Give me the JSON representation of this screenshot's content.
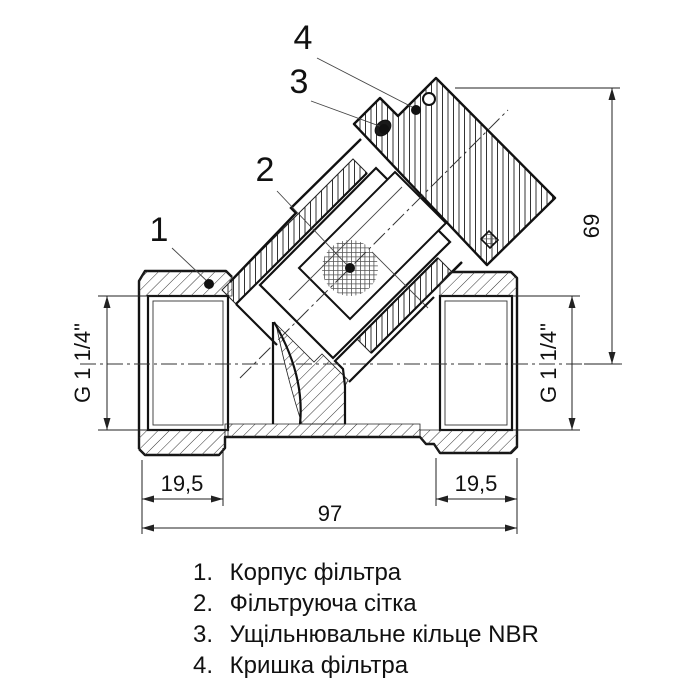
{
  "drawing": {
    "callouts": {
      "c1": "1",
      "c2": "2",
      "c3": "3",
      "c4": "4"
    },
    "dimensions": {
      "thread_left": "G 1 1/4\"",
      "thread_right": "G 1 1/4\"",
      "height": "69",
      "total_length": "97",
      "port_left": "19,5",
      "port_right": "19,5"
    },
    "legend": {
      "items": [
        {
          "number": "1.",
          "label": "Корпус фільтра"
        },
        {
          "number": "2.",
          "label": "Фільтруюча сітка"
        },
        {
          "number": "3.",
          "label": "Ущільнювальне кільце NBR"
        },
        {
          "number": "4.",
          "label": "Кришка фільтра"
        }
      ]
    }
  }
}
